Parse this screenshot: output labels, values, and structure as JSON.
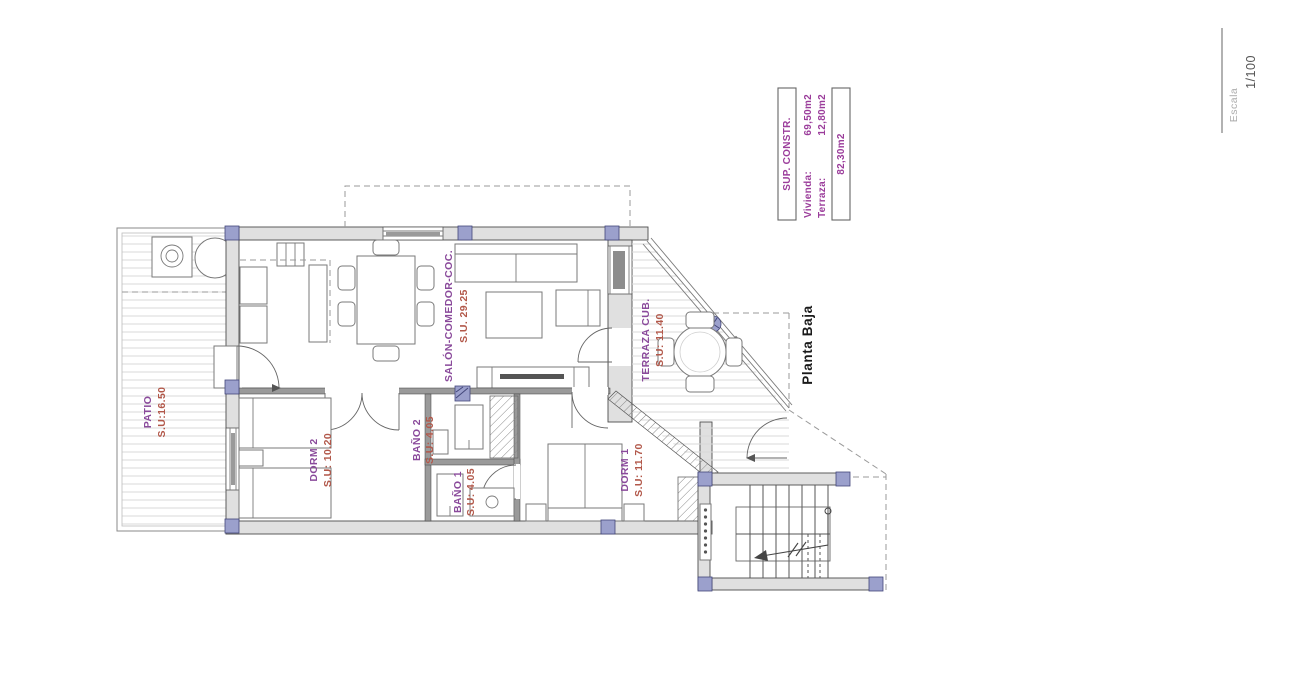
{
  "scale_indicator": {
    "label": "Escala",
    "value": "1/100"
  },
  "legend": {
    "title": "SUP. CONSTR.",
    "rows": [
      {
        "label": "Vivienda:",
        "value": "69,50m2"
      },
      {
        "label": "Terraza:",
        "value": "12,80m2"
      }
    ],
    "total": "82,30m2"
  },
  "plan": {
    "title": "Planta Baja",
    "rooms": {
      "patio": {
        "name": "PATIO",
        "area": "S.U:16.50"
      },
      "salon": {
        "name": "SALÓN-COMEDOR-COC.",
        "area": "S.U. 29.25"
      },
      "terraza": {
        "name": "TERRAZA CUB.",
        "area": "S.U: 11.40"
      },
      "dorm2": {
        "name": "DORM 2",
        "area": "S.U: 10.20"
      },
      "bano2": {
        "name": "BAÑO 2",
        "area": "S.U: 4.05"
      },
      "bano1": {
        "name": "BAÑO 1",
        "area": "S.U: 4.05"
      },
      "dorm1": {
        "name": "DORM 1",
        "area": "S.U: 11.70"
      }
    }
  },
  "colors": {
    "room_name": "#8a4a9b",
    "room_area": "#b2584a",
    "legend_text": "#9b3d9b",
    "wall_fill": "#e0e0e0",
    "column_fill": "#9ba0cc"
  }
}
